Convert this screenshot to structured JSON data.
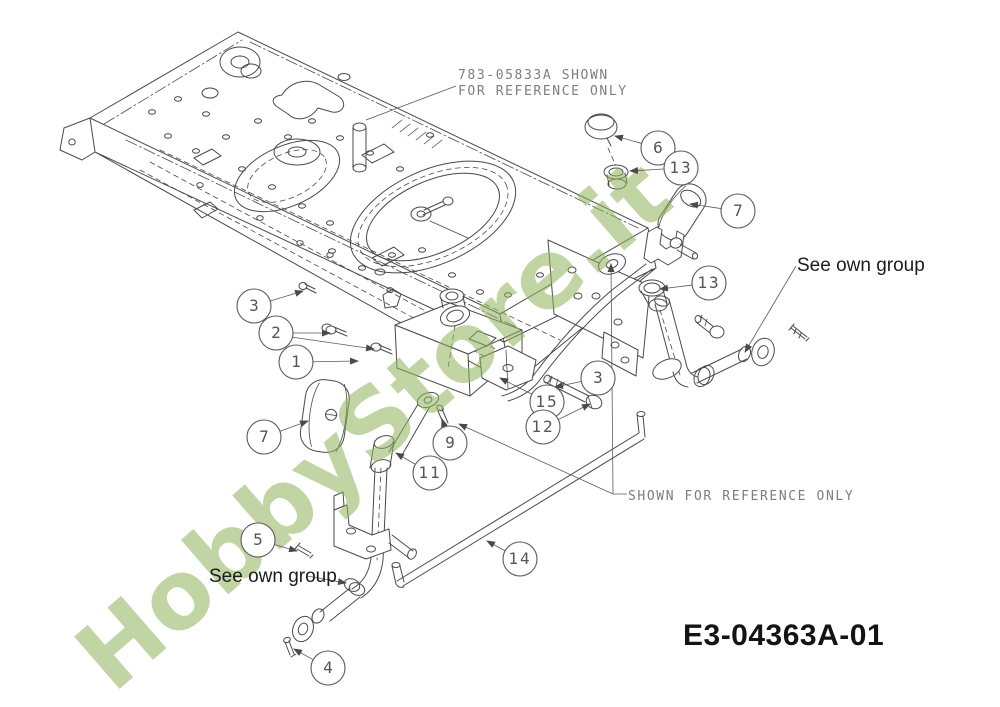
{
  "figure": {
    "drawing_number": "E3-04363A-01",
    "watermark": {
      "text": "HobbyStore.it",
      "color": "#8fb35b"
    },
    "line_color": "#4a4a4a"
  },
  "annotations": {
    "ref_note": {
      "line1": "783-05833A SHOWN",
      "line2": "FOR REFERENCE ONLY"
    },
    "shown_note": {
      "text": "SHOWN FOR REFERENCE ONLY"
    },
    "see_own_group_left": {
      "text": "See own group"
    },
    "see_own_group_right": {
      "text": "See own group"
    },
    "watermark_text": "HobbyStore.it",
    "drawing_number_text": "E3-04363A-01"
  },
  "callouts": [
    {
      "n": "3",
      "cx": 254,
      "cy": 306,
      "lx": 303,
      "ly": 291
    },
    {
      "n": "2",
      "cx": 276,
      "cy": 333,
      "lx": 330,
      "ly": 333
    },
    {
      "n": "1",
      "cx": 296,
      "cy": 362,
      "lx": 358,
      "ly": 361
    },
    {
      "n": "7",
      "cx": 264,
      "cy": 437,
      "lx": 308,
      "ly": 421
    },
    {
      "n": "5",
      "cx": 258,
      "cy": 540,
      "lx": 297,
      "ly": 551
    },
    {
      "n": "4",
      "cx": 328,
      "cy": 668,
      "lx": 294,
      "ly": 649
    },
    {
      "n": "6",
      "cx": 658,
      "cy": 148,
      "lx": 615,
      "ly": 136
    },
    {
      "n": "13",
      "cx": 681,
      "cy": 168,
      "lx": 630,
      "ly": 171
    },
    {
      "n": "7",
      "cx": 738,
      "cy": 211,
      "lx": 690,
      "ly": 204
    },
    {
      "n": "13",
      "cx": 709,
      "cy": 283,
      "lx": 660,
      "ly": 289
    },
    {
      "n": "3",
      "cx": 598,
      "cy": 378,
      "lx": 555,
      "ly": 387
    },
    {
      "n": "15",
      "cx": 547,
      "cy": 402,
      "lx": 500,
      "ly": 378
    },
    {
      "n": "12",
      "cx": 543,
      "cy": 427,
      "lx": 590,
      "ly": 404
    },
    {
      "n": "9",
      "cx": 450,
      "cy": 443,
      "lx": 442,
      "ly": 419
    },
    {
      "n": "11",
      "cx": 430,
      "cy": 473,
      "lx": 396,
      "ly": 453
    },
    {
      "n": "14",
      "cx": 520,
      "cy": 559,
      "lx": 487,
      "ly": 541
    }
  ]
}
